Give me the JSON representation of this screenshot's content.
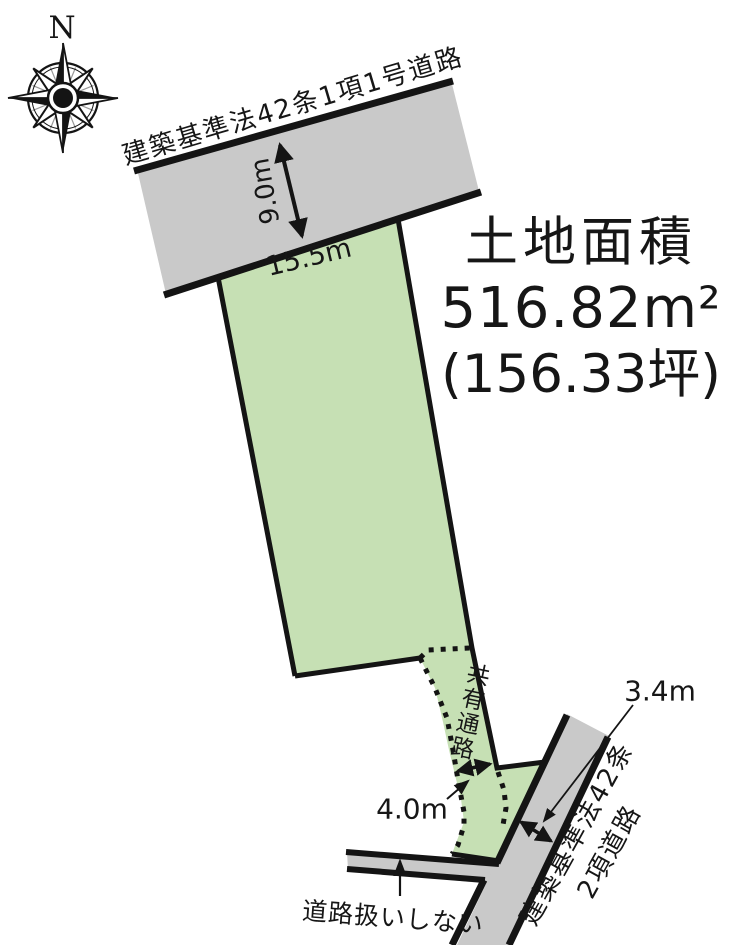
{
  "compass": {
    "north_label": "N"
  },
  "top_road": {
    "name": "建築基準法42条1項1号道路",
    "width": "9.0m"
  },
  "parcel": {
    "frontage": "15.5m",
    "area_title": "土地面積",
    "area_sqm": "516.82m²",
    "area_tsubo": "(156.33坪)",
    "passage": "共有通路",
    "passage_width": "4.0m"
  },
  "bottom_road": {
    "name_line1": "建築基準法42条",
    "name_line2": "2項道路",
    "width": "3.4m",
    "side_note": "道路扱いしない"
  },
  "colors": {
    "parcel_green": "#c6e0b4",
    "road_gray": "#c9c9c9",
    "line_black": "#141414"
  }
}
